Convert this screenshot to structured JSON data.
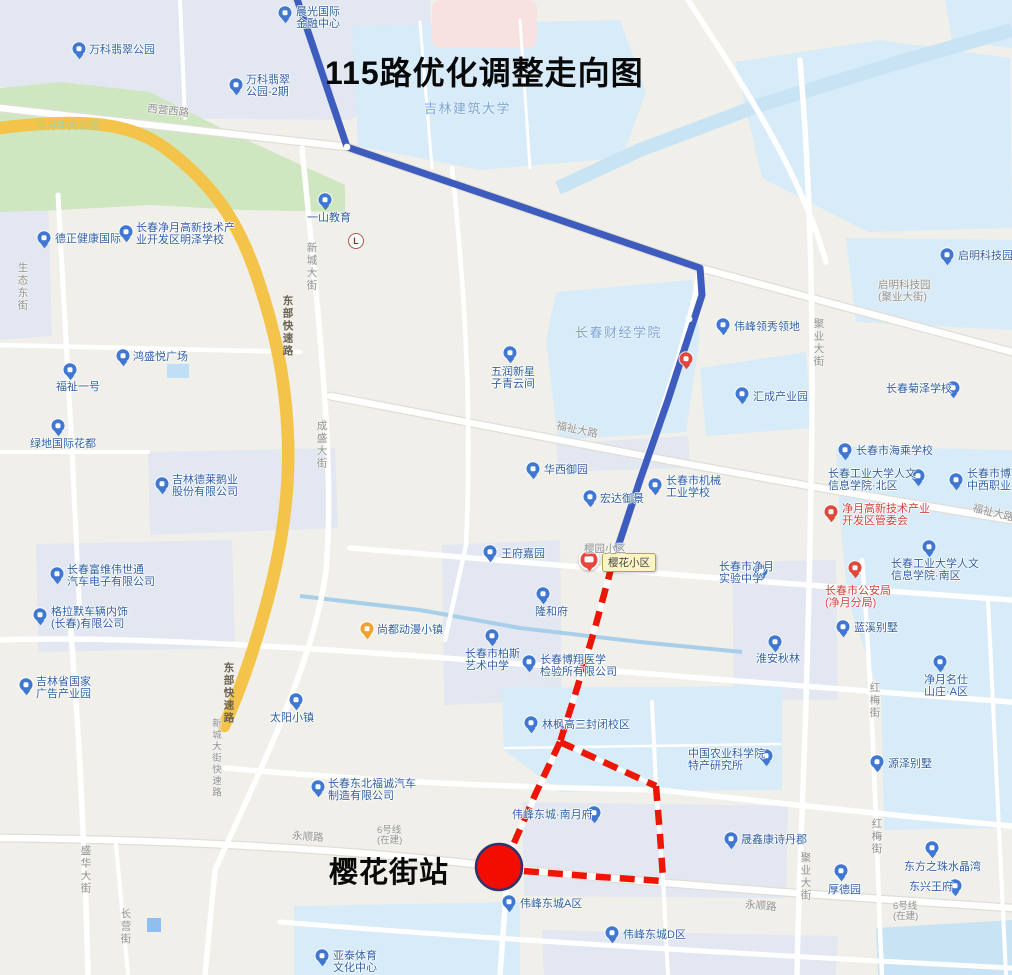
{
  "title": "115路优化调整走向图",
  "station": {
    "label": "樱花街站",
    "circle": {
      "cx": 499,
      "cy": 867,
      "r": 23,
      "fill": "#f20d00",
      "stroke": "#32336e"
    }
  },
  "tooltip": {
    "text": "樱花小区",
    "x": 602,
    "y": 553
  },
  "landmark": {
    "glyph": "L",
    "x": 356,
    "y": 241
  },
  "bus_pin": {
    "x": 589,
    "y": 562
  },
  "colors": {
    "route_existing": "#3d5cbe",
    "route_adjusted": "#ee1505",
    "expressway": "#f4c34a",
    "park": "#cfe7c0",
    "campus": "#d7ebf8",
    "water": "#c7e3f4",
    "poi_blue": "#3f77d2",
    "poi_red": "#e0483c",
    "poi_orange": "#f0a22e"
  },
  "routes": {
    "existing": {
      "name": "115路现行走向(蓝色实线)",
      "points": [
        [
          296,
          -4
        ],
        [
          347,
          147
        ],
        [
          700,
          268
        ],
        [
          702,
          295
        ],
        [
          668,
          400
        ],
        [
          640,
          480
        ],
        [
          612,
          565
        ]
      ],
      "stops": [
        [
          347,
          147
        ],
        [
          689,
          319
        ],
        [
          612,
          551
        ]
      ]
    },
    "adjusted": {
      "name": "115路优化调整走向(红色虚线)",
      "segments": [
        [
          [
            612,
            565
          ],
          [
            595,
            628
          ],
          [
            575,
            695
          ],
          [
            560,
            742
          ]
        ],
        [
          [
            560,
            742
          ],
          [
            535,
            795
          ],
          [
            514,
            843
          ]
        ],
        [
          [
            560,
            742
          ],
          [
            656,
            786
          ]
        ],
        [
          [
            656,
            786
          ],
          [
            660,
            835
          ],
          [
            663,
            878
          ]
        ],
        [
          [
            524,
            871
          ],
          [
            600,
            877
          ],
          [
            663,
            881
          ]
        ]
      ]
    }
  },
  "map": {
    "pois": [
      {
        "n": "chenguang-intl-finance-center",
        "lines": [
          "晨光国际",
          "金融中心"
        ],
        "ix": 285,
        "iy": 14,
        "ic": "blue",
        "tx": 296,
        "ty": 6
      },
      {
        "n": "vanke-jade-park",
        "lines": [
          "万科翡翠公园"
        ],
        "ix": 79,
        "iy": 50,
        "ic": "blue",
        "tx": 89,
        "ty": 44
      },
      {
        "n": "vanke-jade-park-2",
        "lines": [
          "万科翡翠",
          "公园-2期"
        ],
        "ix": 236,
        "iy": 86,
        "ic": "blue",
        "tx": 246,
        "ty": 74
      },
      {
        "n": "yishan-education",
        "lines": [
          "一山教育"
        ],
        "ix": 325,
        "iy": 201,
        "ic": "blue",
        "tx": 307,
        "ty": 212
      },
      {
        "n": "dezheng-health-intl",
        "lines": [
          "德正健康国际"
        ],
        "ix": 44,
        "iy": 239,
        "ic": "blue",
        "tx": 55,
        "ty": 233
      },
      {
        "n": "mingze-school",
        "lines": [
          "长春净月高新技术产",
          "业开发区明泽学校"
        ],
        "ix": 126,
        "iy": 233,
        "ic": "blue",
        "tx": 136,
        "ty": 222
      },
      {
        "n": "qiming-tech-park",
        "lines": [
          "启明科技园"
        ],
        "ix": 947,
        "iy": 256,
        "ic": "blue",
        "tx": 958,
        "ty": 250
      },
      {
        "n": "hongsheng-plaza",
        "lines": [
          "鸿盛悦广场"
        ],
        "ix": 123,
        "iy": 357,
        "ic": "blue",
        "tx": 133,
        "ty": 351
      },
      {
        "n": "fuzhi-no1",
        "lines": [
          "福祉一号"
        ],
        "ix": 70,
        "iy": 371,
        "ic": "blue",
        "tx": 56,
        "ty": 381
      },
      {
        "n": "lvdi-intl-huadu",
        "lines": [
          "绿地国际花都"
        ],
        "ix": 58,
        "iy": 427,
        "ic": "blue",
        "tx": 30,
        "ty": 438
      },
      {
        "n": "juze-school",
        "lines": [
          "长春菊泽学校"
        ],
        "ix": 953,
        "iy": 389,
        "ic": "blue",
        "tx": 886,
        "ty": 383
      },
      {
        "n": "weifeng-lingxiu",
        "lines": [
          "伟峰领秀领地"
        ],
        "ix": 723,
        "iy": 326,
        "ic": "blue",
        "tx": 734,
        "ty": 321
      },
      {
        "n": "huicheng-industry-park",
        "lines": [
          "汇成产业园"
        ],
        "ix": 742,
        "iy": 395,
        "ic": "blue",
        "tx": 753,
        "ty": 391
      },
      {
        "n": "haicheng-school",
        "lines": [
          "长春市海乘学校"
        ],
        "ix": 845,
        "iy": 451,
        "ic": "blue",
        "tx": 856,
        "ty": 445
      },
      {
        "n": "gongda-renwen-north",
        "lines": [
          "长春工业大学人文",
          "信息学院·北区"
        ],
        "ix": 918,
        "iy": 477,
        "ic": "blue",
        "tx": 828,
        "ty": 468
      },
      {
        "n": "boyi-vocational-school",
        "lines": [
          "长春市博艺",
          "中西职业学"
        ],
        "ix": 956,
        "iy": 481,
        "ic": "blue",
        "tx": 967,
        "ty": 468
      },
      {
        "n": "jingyue-hightech-committee",
        "lines": [
          "净月高新技术产业",
          "开发区管委会"
        ],
        "ix": 831,
        "iy": 513,
        "ic": "red",
        "tx": 842,
        "ty": 503,
        "red": true
      },
      {
        "n": "jixie-industry-school",
        "lines": [
          "长春市机械",
          "工业学校"
        ],
        "ix": 655,
        "iy": 486,
        "ic": "blue",
        "tx": 666,
        "ty": 475
      },
      {
        "n": "wurun-xinxing",
        "lines": [
          "五润新星",
          "子青云间"
        ],
        "ix": 510,
        "iy": 354,
        "ic": "blue",
        "tx": 491,
        "ty": 366
      },
      {
        "n": "huaxi-yuyuan",
        "lines": [
          "华西御园"
        ],
        "ix": 533,
        "iy": 470,
        "ic": "blue",
        "tx": 544,
        "ty": 464
      },
      {
        "n": "hongda-yujing",
        "lines": [
          "宏达御景"
        ],
        "ix": 590,
        "iy": 498,
        "ic": "blue",
        "tx": 600,
        "ty": 493
      },
      {
        "n": "wangfu-jiayuan",
        "lines": [
          "王府嘉园"
        ],
        "ix": 490,
        "iy": 553,
        "ic": "blue",
        "tx": 501,
        "ty": 548
      },
      {
        "n": "longhefu",
        "lines": [
          "隆和府"
        ],
        "ix": 543,
        "iy": 595,
        "ic": "blue",
        "tx": 535,
        "ty": 606
      },
      {
        "n": "baisi-art-school",
        "lines": [
          "长春市柏斯",
          "艺术中学"
        ],
        "ix": 492,
        "iy": 637,
        "ic": "blue",
        "tx": 465,
        "ty": 648
      },
      {
        "n": "boxiang-medical-lab",
        "lines": [
          "长春博翔医学",
          "检验所有限公司"
        ],
        "ix": 529,
        "iy": 663,
        "ic": "blue",
        "tx": 540,
        "ty": 654
      },
      {
        "n": "gaosan-campus",
        "lines": [
          "林枫高三封闭校区"
        ],
        "ix": 531,
        "iy": 724,
        "ic": "blue",
        "tx": 542,
        "ty": 719
      },
      {
        "n": "agri-academy-institute",
        "lines": [
          "中国农业科学院",
          "特产研究所"
        ],
        "ix": 766,
        "iy": 757,
        "ic": "blue",
        "tx": 688,
        "ty": 748
      },
      {
        "n": "weifeng-nanyuefu",
        "lines": [
          "伟峰东城·南月府"
        ],
        "ix": 594,
        "iy": 814,
        "ic": "blue",
        "tx": 512,
        "ty": 809
      },
      {
        "n": "fucheng-auto",
        "lines": [
          "长春东北福诚汽车",
          "制造有限公司"
        ],
        "ix": 318,
        "iy": 788,
        "ic": "blue",
        "tx": 328,
        "ty": 778
      },
      {
        "n": "taiyang-town",
        "lines": [
          "太阳小镇"
        ],
        "ix": 296,
        "iy": 701,
        "ic": "blue",
        "tx": 270,
        "ty": 712
      },
      {
        "n": "shangdu-anime-town",
        "lines": [
          "尚都动漫小镇"
        ],
        "ix": 367,
        "iy": 630,
        "ic": "orange",
        "tx": 377,
        "ty": 624
      },
      {
        "n": "jilin-elai-goose",
        "lines": [
          "吉林德莱鹅业",
          "股份有限公司"
        ],
        "ix": 162,
        "iy": 485,
        "ic": "blue",
        "tx": 172,
        "ty": 474
      },
      {
        "n": "fuwei-visteon",
        "lines": [
          "长春富维伟世通",
          "汽车电子有限公司"
        ],
        "ix": 57,
        "iy": 575,
        "ic": "blue",
        "tx": 67,
        "ty": 564
      },
      {
        "n": "grammer-interior",
        "lines": [
          "格拉默车辆内饰",
          "(长春)有限公司"
        ],
        "ix": 40,
        "iy": 616,
        "ic": "blue",
        "tx": 51,
        "ty": 606
      },
      {
        "n": "jilin-ad-industry-park",
        "lines": [
          "吉林省国家",
          "广告产业园"
        ],
        "ix": 26,
        "iy": 686,
        "ic": "blue",
        "tx": 36,
        "ty": 676
      },
      {
        "n": "shengxin-kangshidanjun",
        "lines": [
          "晟鑫康诗丹郡"
        ],
        "ix": 731,
        "iy": 840,
        "ic": "blue",
        "tx": 741,
        "ty": 834
      },
      {
        "n": "houdeyuan",
        "lines": [
          "厚德园"
        ],
        "ix": 841,
        "iy": 872,
        "ic": "blue",
        "tx": 828,
        "ty": 884
      },
      {
        "n": "dongfangzhizhu-crystal-bay",
        "lines": [
          "东方之珠水晶湾"
        ],
        "ix": 932,
        "iy": 849,
        "ic": "blue",
        "tx": 904,
        "ty": 861
      },
      {
        "n": "dongxing-wangfu",
        "lines": [
          "东兴王府"
        ],
        "ix": 955,
        "iy": 887,
        "ic": "blue",
        "tx": 909,
        "ty": 881
      },
      {
        "n": "weifeng-dongcheng-a",
        "lines": [
          "伟峰东城A区"
        ],
        "ix": 509,
        "iy": 903,
        "ic": "blue",
        "tx": 520,
        "ty": 898
      },
      {
        "n": "weifeng-dongcheng-d",
        "lines": [
          "伟峰东城D区"
        ],
        "ix": 612,
        "iy": 934,
        "ic": "blue",
        "tx": 623,
        "ty": 929
      },
      {
        "n": "yatai-sports-center",
        "lines": [
          "亚泰体育",
          "文化中心"
        ],
        "ix": 322,
        "iy": 957,
        "ic": "blue",
        "tx": 333,
        "ty": 950
      },
      {
        "n": "jingyue-shiyan-middle-school",
        "lines": [
          "长春市净月",
          "实验中学"
        ],
        "ix": 761,
        "iy": 572,
        "ic": "blue",
        "tx": 719,
        "ty": 561
      },
      {
        "n": "lanxi-villa",
        "lines": [
          "蓝溪别墅"
        ],
        "ix": 843,
        "iy": 628,
        "ic": "blue",
        "tx": 854,
        "ty": 622
      },
      {
        "n": "huaian-qiulin",
        "lines": [
          "淮安秋林"
        ],
        "ix": 775,
        "iy": 643,
        "ic": "blue",
        "tx": 756,
        "ty": 653
      },
      {
        "n": "jingyue-mingshi-villa-a",
        "lines": [
          "净月名仕",
          "山庄·A区"
        ],
        "ix": 940,
        "iy": 663,
        "ic": "blue",
        "tx": 924,
        "ty": 674
      },
      {
        "n": "yuanze-villa",
        "lines": [
          "源泽别墅"
        ],
        "ix": 877,
        "iy": 763,
        "ic": "blue",
        "tx": 888,
        "ty": 758
      },
      {
        "n": "public-security-jingyue",
        "lines": [
          "长春市公安局",
          "(净月分局)"
        ],
        "ix": 855,
        "iy": 569,
        "ic": "red",
        "tx": 825,
        "ty": 585,
        "red": true
      },
      {
        "n": "gongda-renwen-south",
        "lines": [
          "长春工业大学人文",
          "信息学院·南区"
        ],
        "ix": 929,
        "iy": 548,
        "ic": "blue",
        "tx": 891,
        "ty": 558
      },
      {
        "n": "red-poi-marker",
        "lines": [],
        "ix": 686,
        "iy": 360,
        "ic": "red"
      }
    ],
    "area_labels": [
      {
        "n": "jilin-jianzhu-university",
        "lines": [
          "吉林建筑大学"
        ],
        "x": 424,
        "y": 98
      },
      {
        "n": "changchun-finance-college",
        "lines": [
          "长春财经学院"
        ],
        "x": 575,
        "y": 322
      }
    ],
    "street_labels": [
      {
        "n": "xiying-west-road",
        "lines": [
          "西营西路"
        ],
        "x": 147,
        "y": 106,
        "mode": "h",
        "rot": 6
      },
      {
        "n": "shengtai-east-street",
        "lines": [
          "生态东街"
        ],
        "x": 16,
        "y": 262,
        "mode": "v"
      },
      {
        "n": "xincheng-street",
        "lines": [
          "新城大街"
        ],
        "x": 305,
        "y": 242,
        "mode": "v"
      },
      {
        "n": "chengsheng-street",
        "lines": [
          "成盛大街"
        ],
        "x": 315,
        "y": 420,
        "mode": "v"
      },
      {
        "n": "juye-street-north",
        "lines": [
          "聚业大街"
        ],
        "x": 812,
        "y": 318,
        "mode": "v"
      },
      {
        "n": "juye-street-south",
        "lines": [
          "聚业大街"
        ],
        "x": 799,
        "y": 852,
        "mode": "v"
      },
      {
        "n": "fuzhi-road-mid",
        "lines": [
          "福祉大路"
        ],
        "x": 556,
        "y": 425,
        "mode": "h",
        "rot": 12
      },
      {
        "n": "fuzhi-road-east",
        "lines": [
          "福祉大路"
        ],
        "x": 972,
        "y": 508,
        "mode": "h",
        "rot": 14
      },
      {
        "n": "hongmei-street-n",
        "lines": [
          "红梅街"
        ],
        "x": 868,
        "y": 682,
        "mode": "v"
      },
      {
        "n": "hongmei-street-s",
        "lines": [
          "红梅街"
        ],
        "x": 870,
        "y": 818,
        "mode": "v"
      },
      {
        "n": "yongshun-road-west",
        "lines": [
          "永顺路"
        ],
        "x": 292,
        "y": 832,
        "mode": "h",
        "rot": 4
      },
      {
        "n": "yongshun-road-east",
        "lines": [
          "永顺路"
        ],
        "x": 745,
        "y": 901,
        "mode": "h",
        "rot": 5
      },
      {
        "n": "shenghua-street",
        "lines": [
          "盛华大街"
        ],
        "x": 79,
        "y": 845,
        "mode": "v"
      },
      {
        "n": "changying-street",
        "lines": [
          "长营街"
        ],
        "x": 119,
        "y": 908,
        "mode": "v"
      },
      {
        "n": "xincheng-expressway-name",
        "lines": [
          "新城大街快速路"
        ],
        "x": 210,
        "y": 718,
        "mode": "v",
        "cls": "small"
      },
      {
        "n": "east-expressway-n",
        "lines": [
          "东部快速路"
        ],
        "x": 281,
        "y": 295,
        "mode": "v",
        "cls": "dark"
      },
      {
        "n": "east-expressway-s",
        "lines": [
          "东部快速路"
        ],
        "x": 222,
        "y": 662,
        "mode": "v",
        "cls": "dark"
      },
      {
        "n": "qiming-tech-park-juye",
        "lines": [
          "启明科技园",
          "(聚业大街)"
        ],
        "x": 878,
        "y": 280,
        "mode": "h"
      },
      {
        "n": "metro-line6-station",
        "lines": [
          "6号线",
          "(在建)"
        ],
        "x": 377,
        "y": 826,
        "mode": "h",
        "cls": "small"
      },
      {
        "n": "metro-line6-east",
        "lines": [
          "6号线",
          "(在建)"
        ],
        "x": 893,
        "y": 902,
        "mode": "h",
        "cls": "small"
      },
      {
        "n": "yingyuan-community",
        "lines": [
          "樱园小区"
        ],
        "x": 584,
        "y": 544,
        "mode": "h"
      },
      {
        "n": "jingyue-central-park",
        "lines": [
          "净月中央公园"
        ],
        "x": 36,
        "y": 121,
        "mode": "h",
        "cls": "park"
      }
    ]
  }
}
